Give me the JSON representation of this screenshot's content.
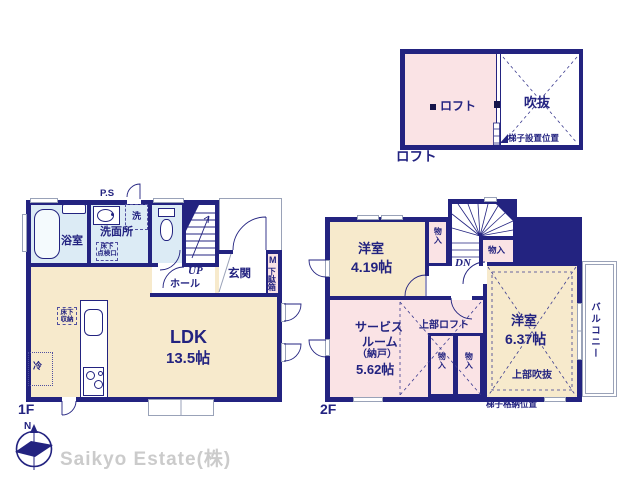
{
  "colors": {
    "wall_navy": "#232380",
    "room_beige": "#f7eacc",
    "room_pink": "#fae3e5",
    "wet_blue": "#dcebf5",
    "window_gray": "#99a2b8",
    "company_gray": "#cbcbcb"
  },
  "footer": {
    "company": "Saikyo Estate(株)",
    "compass_north": "N"
  },
  "loft": {
    "caption": "ロフト",
    "room_label": "ロフト",
    "void_label": "吹抜",
    "ladder_note": "梯子設置位置"
  },
  "f1": {
    "caption": "1F",
    "ps": "P.S",
    "bath": "浴室",
    "laundry": "洗",
    "washroom": "洗面所",
    "hatch_line1": "床下",
    "hatch_line2": "点検口",
    "up": "UP",
    "hall": "ホール",
    "entrance": "玄関",
    "meter": "M",
    "shoe_cabinet": "下駄箱",
    "ldk": "LDK",
    "ldk_size": "13.5帖",
    "floor_storage_line1": "床下",
    "floor_storage_line2": "収納",
    "fridge": "冷"
  },
  "f2": {
    "caption": "2F",
    "room1": "洋室",
    "room1_size": "4.19帖",
    "down": "DN",
    "closet": "物入",
    "room2": "洋室",
    "room2_size": "6.37帖",
    "upper_void": "上部吹抜",
    "upper_loft": "上部ロフト",
    "service_line1": "サービス",
    "service_line2": "ルーム",
    "service_line3": "（納戸）",
    "service_line4": "5.62帖",
    "balcony": "バルコニー",
    "ladder_note": "梯子格納位置"
  }
}
